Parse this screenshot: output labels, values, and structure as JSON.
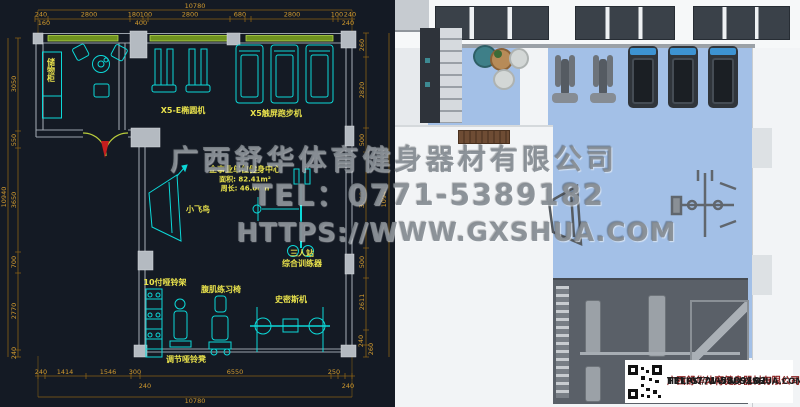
{
  "watermark": {
    "line1": "广西舒华体育健身器材有限公司",
    "line2": "TEL：0771-5389182",
    "line3": "HTTPS://WWW.GXSHUA.COM"
  },
  "cad": {
    "center": {
      "title": "企事业单位健身中心",
      "area": "面积: 82.41m²",
      "perimeter": "周长: 46.08m"
    },
    "labels": {
      "storage": "储物柜",
      "elliptical": "X5-E椭圆机",
      "treadmill": "X5触屏跑步机",
      "fly": "小飞鸟",
      "station_line1": "三人站",
      "station_line2": "综合训练器",
      "dumbbell_rack": "10付哑铃架",
      "ab_chair": "腹肌练习椅",
      "smith": "史密斯机",
      "adj_bench": "调节哑铃凳"
    },
    "dims": {
      "top_total": "10780",
      "top": [
        "240",
        "2800",
        "180",
        "100",
        "2800",
        "680",
        "2800",
        "100",
        "240"
      ],
      "top_sub": [
        "160",
        "400",
        "240"
      ],
      "left_total": "10940",
      "left": [
        "3050",
        "550",
        "3650",
        "700",
        "2770",
        "240"
      ],
      "right": [
        "260",
        "2820",
        "500",
        "3749",
        "500",
        "2611",
        "240",
        "260"
      ],
      "right_total": "10940",
      "bottom": [
        "240",
        "1414",
        "1546",
        "300",
        "6550",
        "250"
      ],
      "bottom_sub": [
        "240",
        "240"
      ],
      "bottom_total": "10780"
    }
  },
  "render3d": {
    "infobox": {
      "company": "广西舒华体育健身器材有限公司",
      "tel": "TEL:0771-5389182",
      "url": "HTTPS://WWW.GXSHUA.COM"
    }
  },
  "colors": {
    "cad_bg": "#141a24",
    "equipment_cyan": "#0cd8d8",
    "dim_orange": "#d0992e",
    "label_yellow": "#e9e24c",
    "window_green": "#6f921f",
    "door_red": "#c41e1e",
    "floor_blue": "#a3c0e7",
    "mat_grey": "#5a6068",
    "console_blue": "#3d93d2",
    "company_red": "#8c1f1f"
  }
}
